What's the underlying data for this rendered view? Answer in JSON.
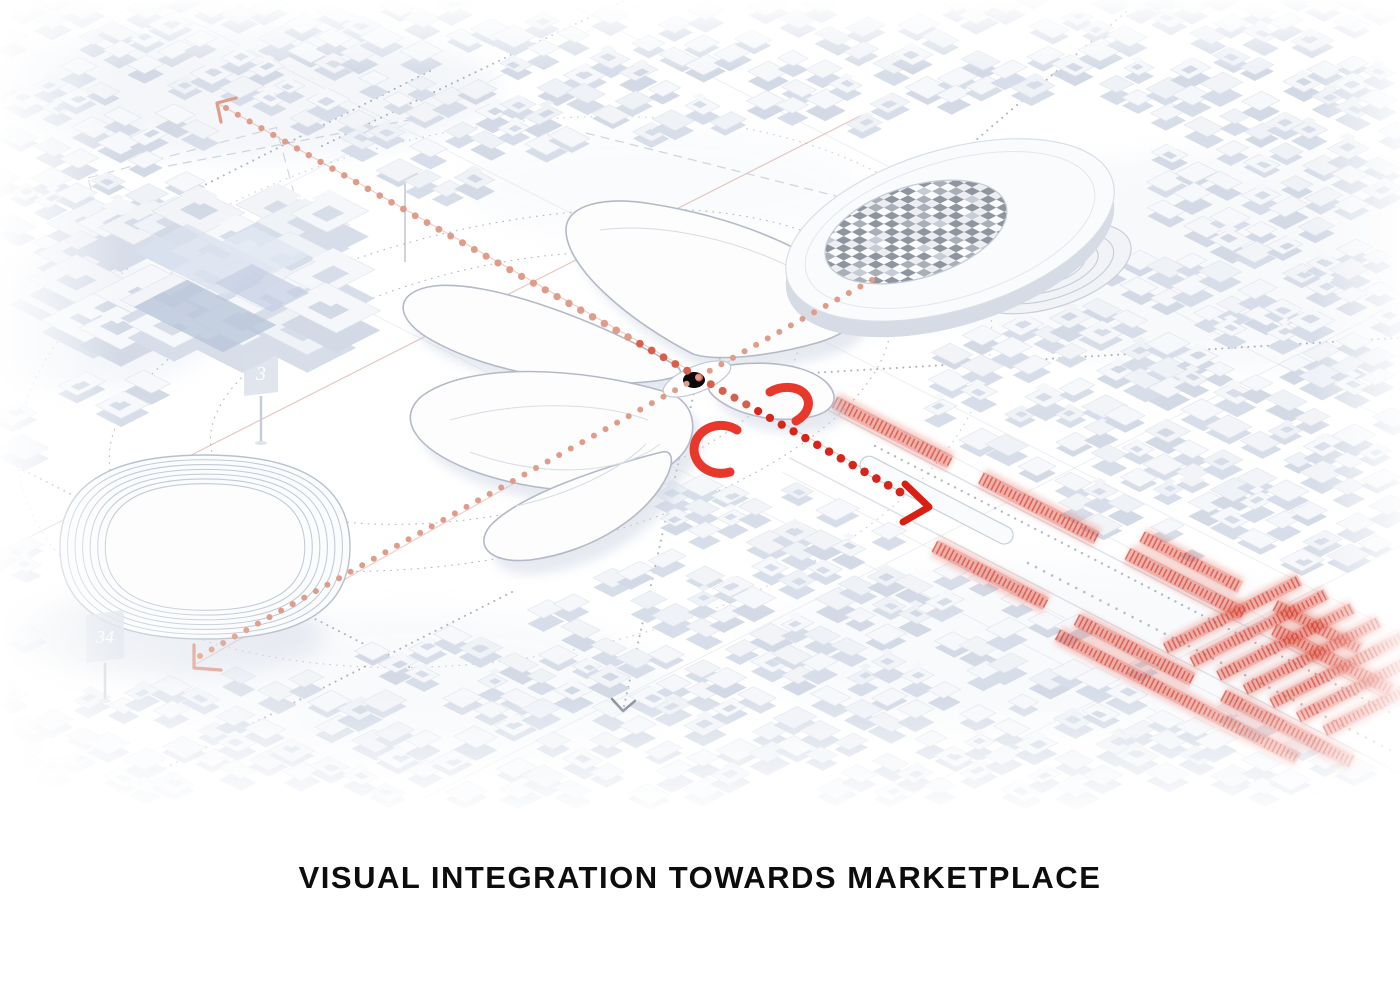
{
  "title": {
    "text": "VISUAL INTEGRATION TOWARDS MARKETPLACE"
  },
  "signs": [
    {
      "label": "3"
    },
    {
      "label": "34"
    }
  ],
  "icons": {
    "viewpoint_dot": "black-dot-marker",
    "arrowhead_marketplace": "red-chevron-arrow",
    "arrowhead_northwest": "salmon-chevron-arrow",
    "corner_bracket_southwest": "salmon-corner-bracket",
    "arrowhead_south": "gray-chevron-arrow"
  },
  "colors": {
    "accent_red": "#da1f12",
    "arc_red": "#e8372b",
    "stall_red": "#cb3a2b",
    "stall_glow": "#e4604e",
    "salmon": "#df9c8a",
    "salmon_line": "#daa394",
    "dot_gray": "#8d939e",
    "line_gray": "#dde2ea",
    "dash_gray": "#c6ccd7",
    "city_top": "#f5f7fa",
    "city_side": "#d8dee9",
    "stroke_light": "#b9c0cc",
    "ink": "#0d0d0d"
  }
}
